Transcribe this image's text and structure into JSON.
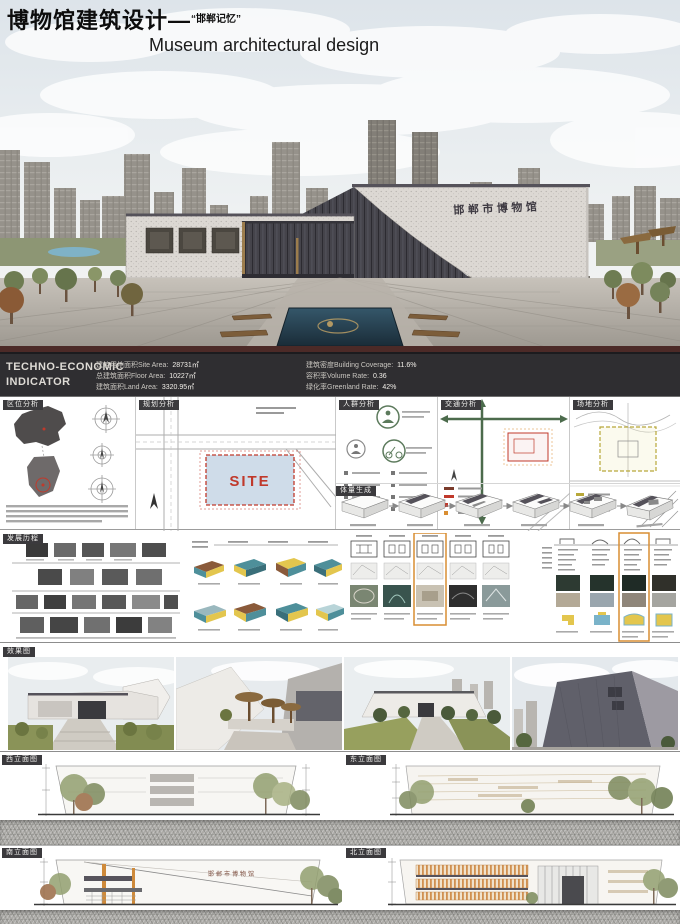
{
  "poster": {
    "title_zh": "博物馆建筑设计",
    "title_dash": "—",
    "title_quote": "“邯郸记忆”",
    "title_en": "Museum architectural design",
    "building_sign": "邯郸市博物馆"
  },
  "indicator": {
    "title_line1": "TECHNO-ECONOMIC",
    "title_line2": "INDICATOR",
    "stats_left": [
      {
        "label": "建筑用地面积Site Area:",
        "value": "28731㎡"
      },
      {
        "label": "总建筑面积Floor Area:",
        "value": "10227㎡"
      },
      {
        "label": "建筑面积Land Area:",
        "value": "3320.95㎡"
      }
    ],
    "stats_right": [
      {
        "label": "建筑密度Building Coverage:",
        "value": "11.6%"
      },
      {
        "label": "容积率Volume Rate:",
        "value": "0.36"
      },
      {
        "label": "绿化率Greenland Rate:",
        "value": "42%"
      }
    ]
  },
  "sections": {
    "location": "区位分析",
    "planning": "规划分析",
    "crowd": "人群分析",
    "traffic": "交通分析",
    "site": "场地分析",
    "massing": "体量生成",
    "development": "发展历程",
    "renders": "效果图",
    "site_label": "SITE"
  },
  "elevations": {
    "west": "西立面图",
    "east": "东立面图",
    "south": "南立面图",
    "north": "北立面图",
    "sign": "邯郸市博物馆"
  },
  "colors": {
    "accent_red": "#c0392b",
    "accent_orange": "#d98e32",
    "accent_green": "#4c6b4c",
    "banner_bg": "#2f2e31",
    "pool_blue": "#27404f"
  }
}
